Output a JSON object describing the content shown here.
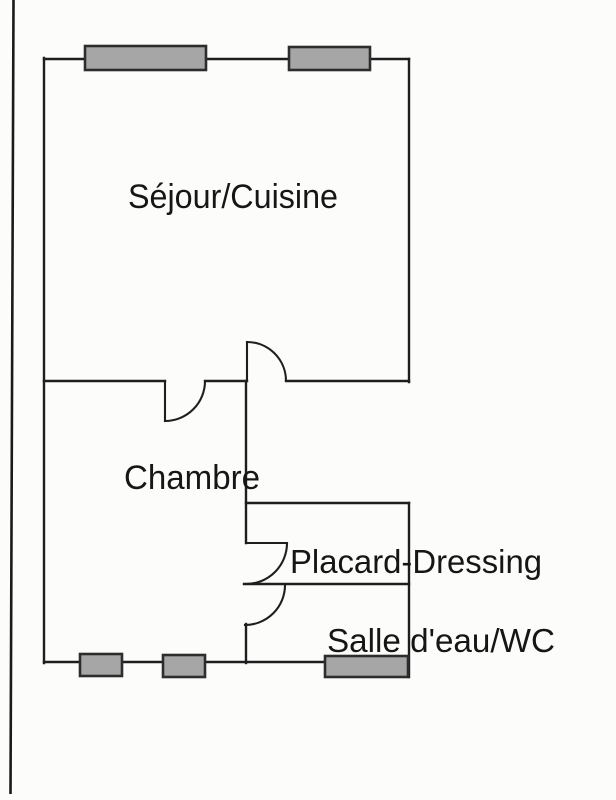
{
  "floorplan": {
    "rooms": [
      {
        "id": "sejour-cuisine",
        "label": "Séjour/Cuisine"
      },
      {
        "id": "chambre",
        "label": "Chambre"
      },
      {
        "id": "placard-dressing",
        "label": "Placard-Dressing"
      },
      {
        "id": "salle-deau-wc",
        "label": "Salle d'eau/WC"
      }
    ],
    "colors": {
      "wall": "#1e1e1e",
      "door": "#1e1e1e",
      "text": "#161616",
      "window_fill": "#a6a6a6",
      "window_border": "#2d2d2d",
      "page_border": "#1a1a1a",
      "background": "#fcfcfb"
    }
  }
}
